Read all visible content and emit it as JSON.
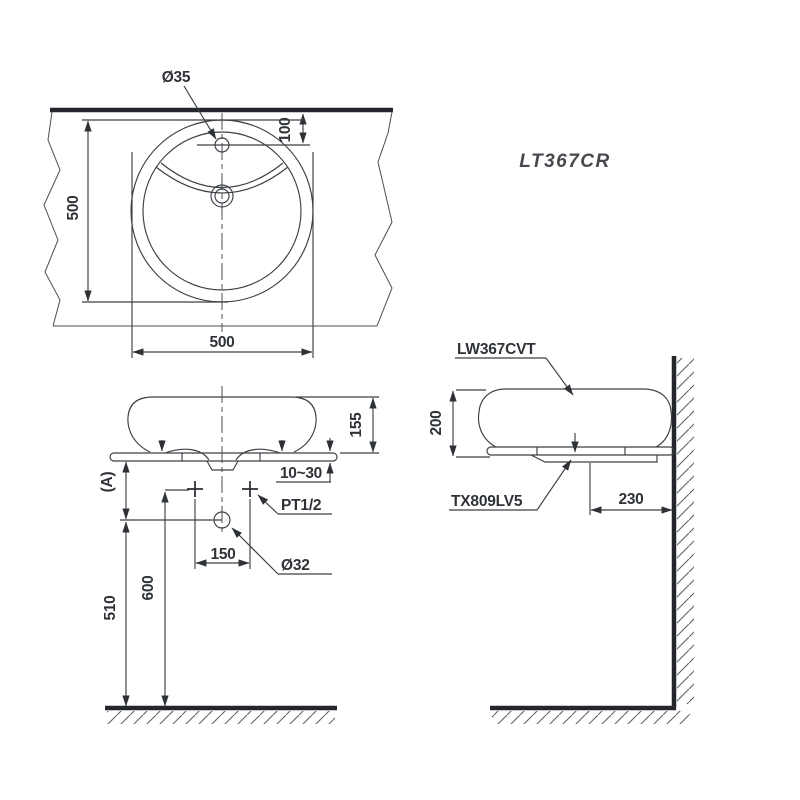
{
  "drawing": {
    "product_code": "LT367CR",
    "top_view": {
      "faucet_hole_dia": "Ø35",
      "faucet_offset": "100",
      "depth": "500",
      "width": "500"
    },
    "front_view": {
      "basin_height": "155",
      "counter_thickness": "10~30",
      "supply_thread": "PT1/2",
      "faucet_pitch": "150",
      "drain_dia": "Ø32",
      "dim_a": "(A)",
      "supply_height": "600",
      "drain_center_height": "510"
    },
    "side_view": {
      "basin_model": "LW367CVT",
      "basin_total_height": "200",
      "drain_model": "TX809LV5",
      "drain_offset_from_wall": "230"
    }
  }
}
